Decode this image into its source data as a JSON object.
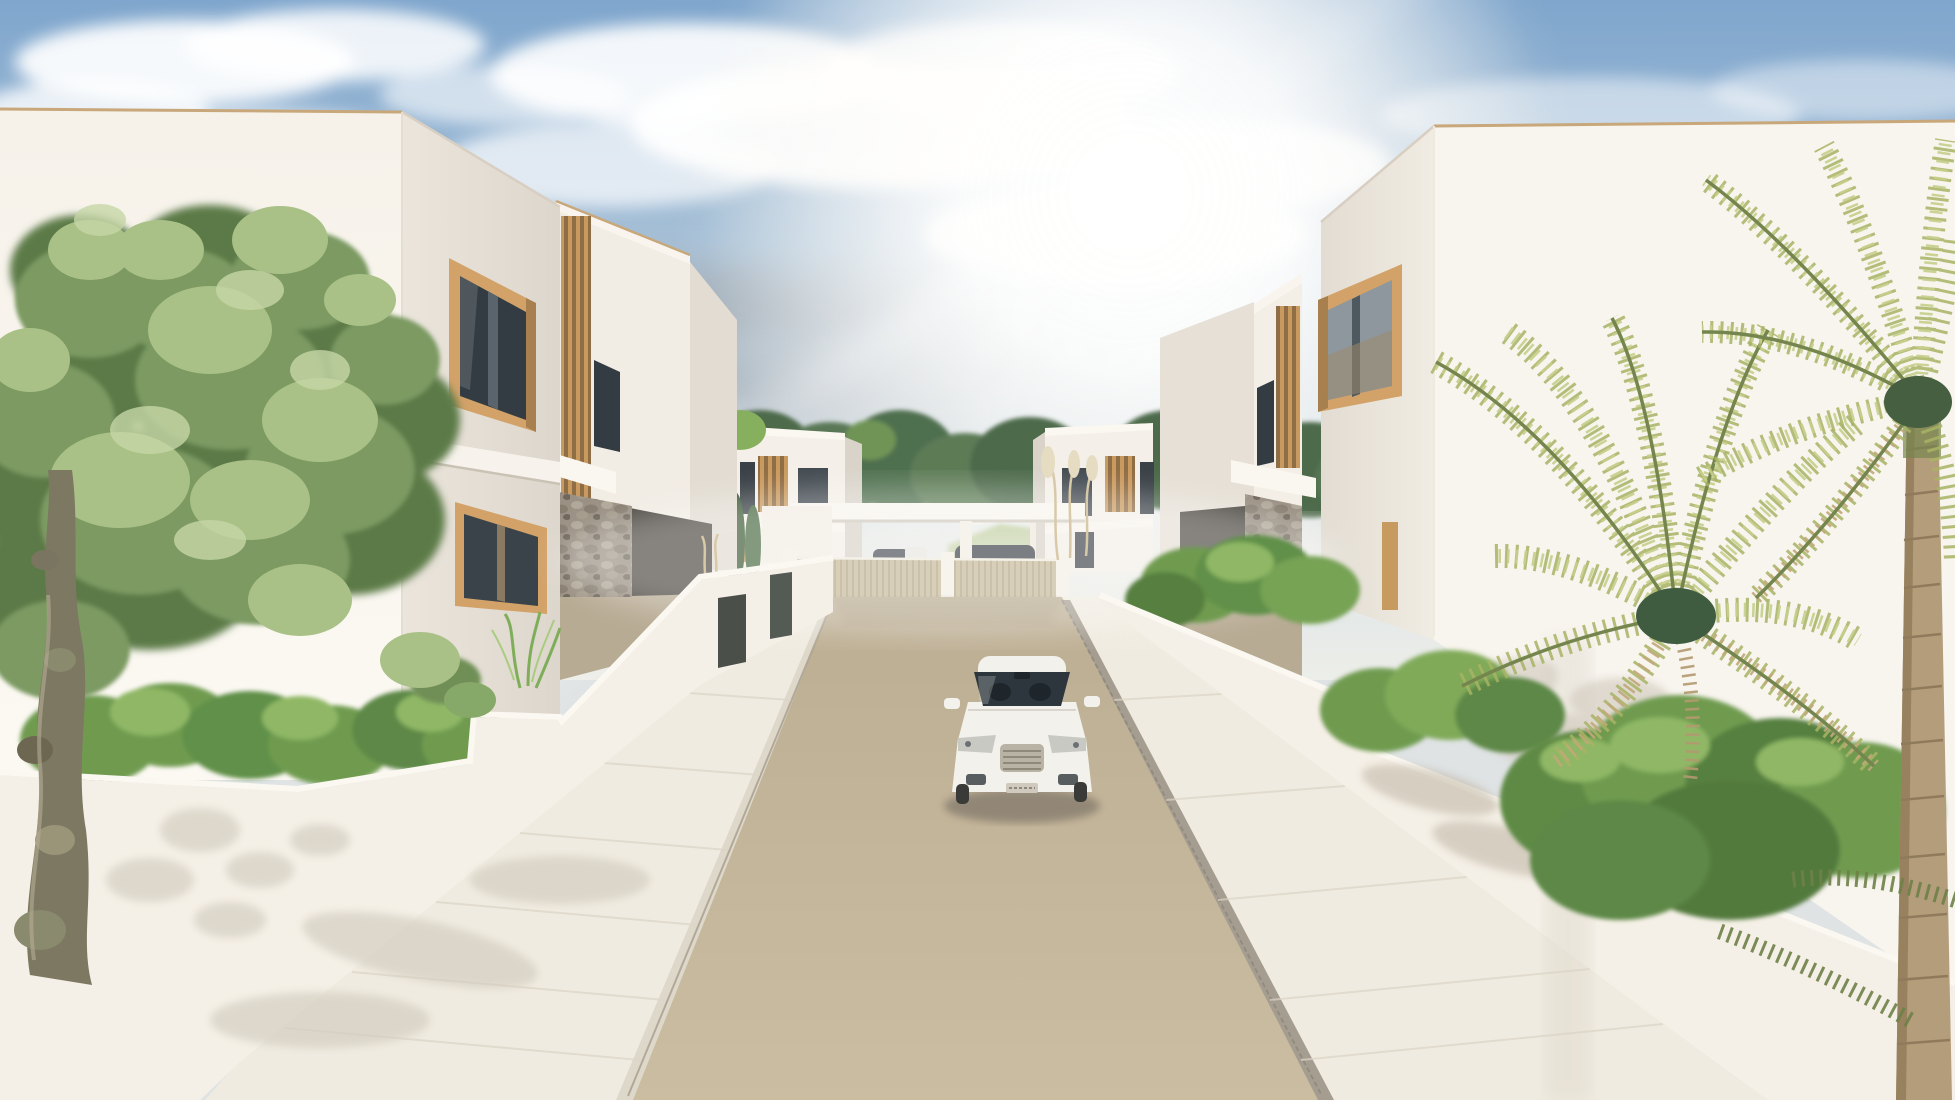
{
  "scene": {
    "kind": "3d-architectural-render",
    "subject": "modern-white-villa-development-street-view",
    "sky": {
      "top": "#7fa6cd",
      "upper": "#a9c2d8",
      "mid": "#cfdce4",
      "horizon": "#edeee9",
      "sun": "#ffffff",
      "glow": "#fdf7ea",
      "cloud_white": "#ffffff",
      "cloud_gray": "#a6b0b9"
    },
    "architecture": {
      "wall_sunlit": "#f8f4ee",
      "wall_front": "#eae4dc",
      "wall_shaded": "#dfd9d0",
      "boundary_wall": "#f5f0e7",
      "coping": "#c8a77b",
      "wood_frame": "#d2a269",
      "wood_dark": "#8f6d45",
      "glass_dark": "#333c43",
      "glass_sky": "#8e979e",
      "stone": "#9a9083",
      "carport_shadow": "#4e4a44",
      "driveway": "#b8ab94"
    },
    "ground": {
      "street": "#cbbda1",
      "street_far": "#bcae93",
      "sidewalk": "#f0ebe0",
      "curb": "#a59d90",
      "joint": "#dcd5c7",
      "gate_shadow": "#a8997e"
    },
    "landscape": {
      "fence": "#c6b998",
      "fence_slat": "#b2a383",
      "pillar": "#f4efe6",
      "treeline": "#4d6a4c",
      "treeline_light": "#7fa05e",
      "grass": "#a3bb77",
      "hedge": "#6f9b4f",
      "hedge_light": "#8fb765",
      "hedge_dark": "#567f3f",
      "olive_dark": "#5c7a46",
      "olive_mid": "#7c9a62",
      "olive_light": "#a9c187",
      "olive_glint": "#c6d6a6",
      "trunk": "#7d7862",
      "branch": "#6b654d",
      "moss": "#8a8a6e",
      "palm_frond": "#a8b465",
      "palm_frond_light": "#c6cf8b",
      "palm_dry": "#c2a87a",
      "palm_core": "#3f5c40",
      "palm_trunk": "#b49d7b",
      "palm_ring": "#8f7a5c",
      "pampas": "#d8c9a8"
    },
    "vehicle": {
      "body": "#f3f1ec",
      "glass": "#2c363c",
      "trim": "#b9b3a6",
      "light": "#c9c9c4",
      "shadow": "#8a8071",
      "dark_car": "#3d4348"
    }
  }
}
